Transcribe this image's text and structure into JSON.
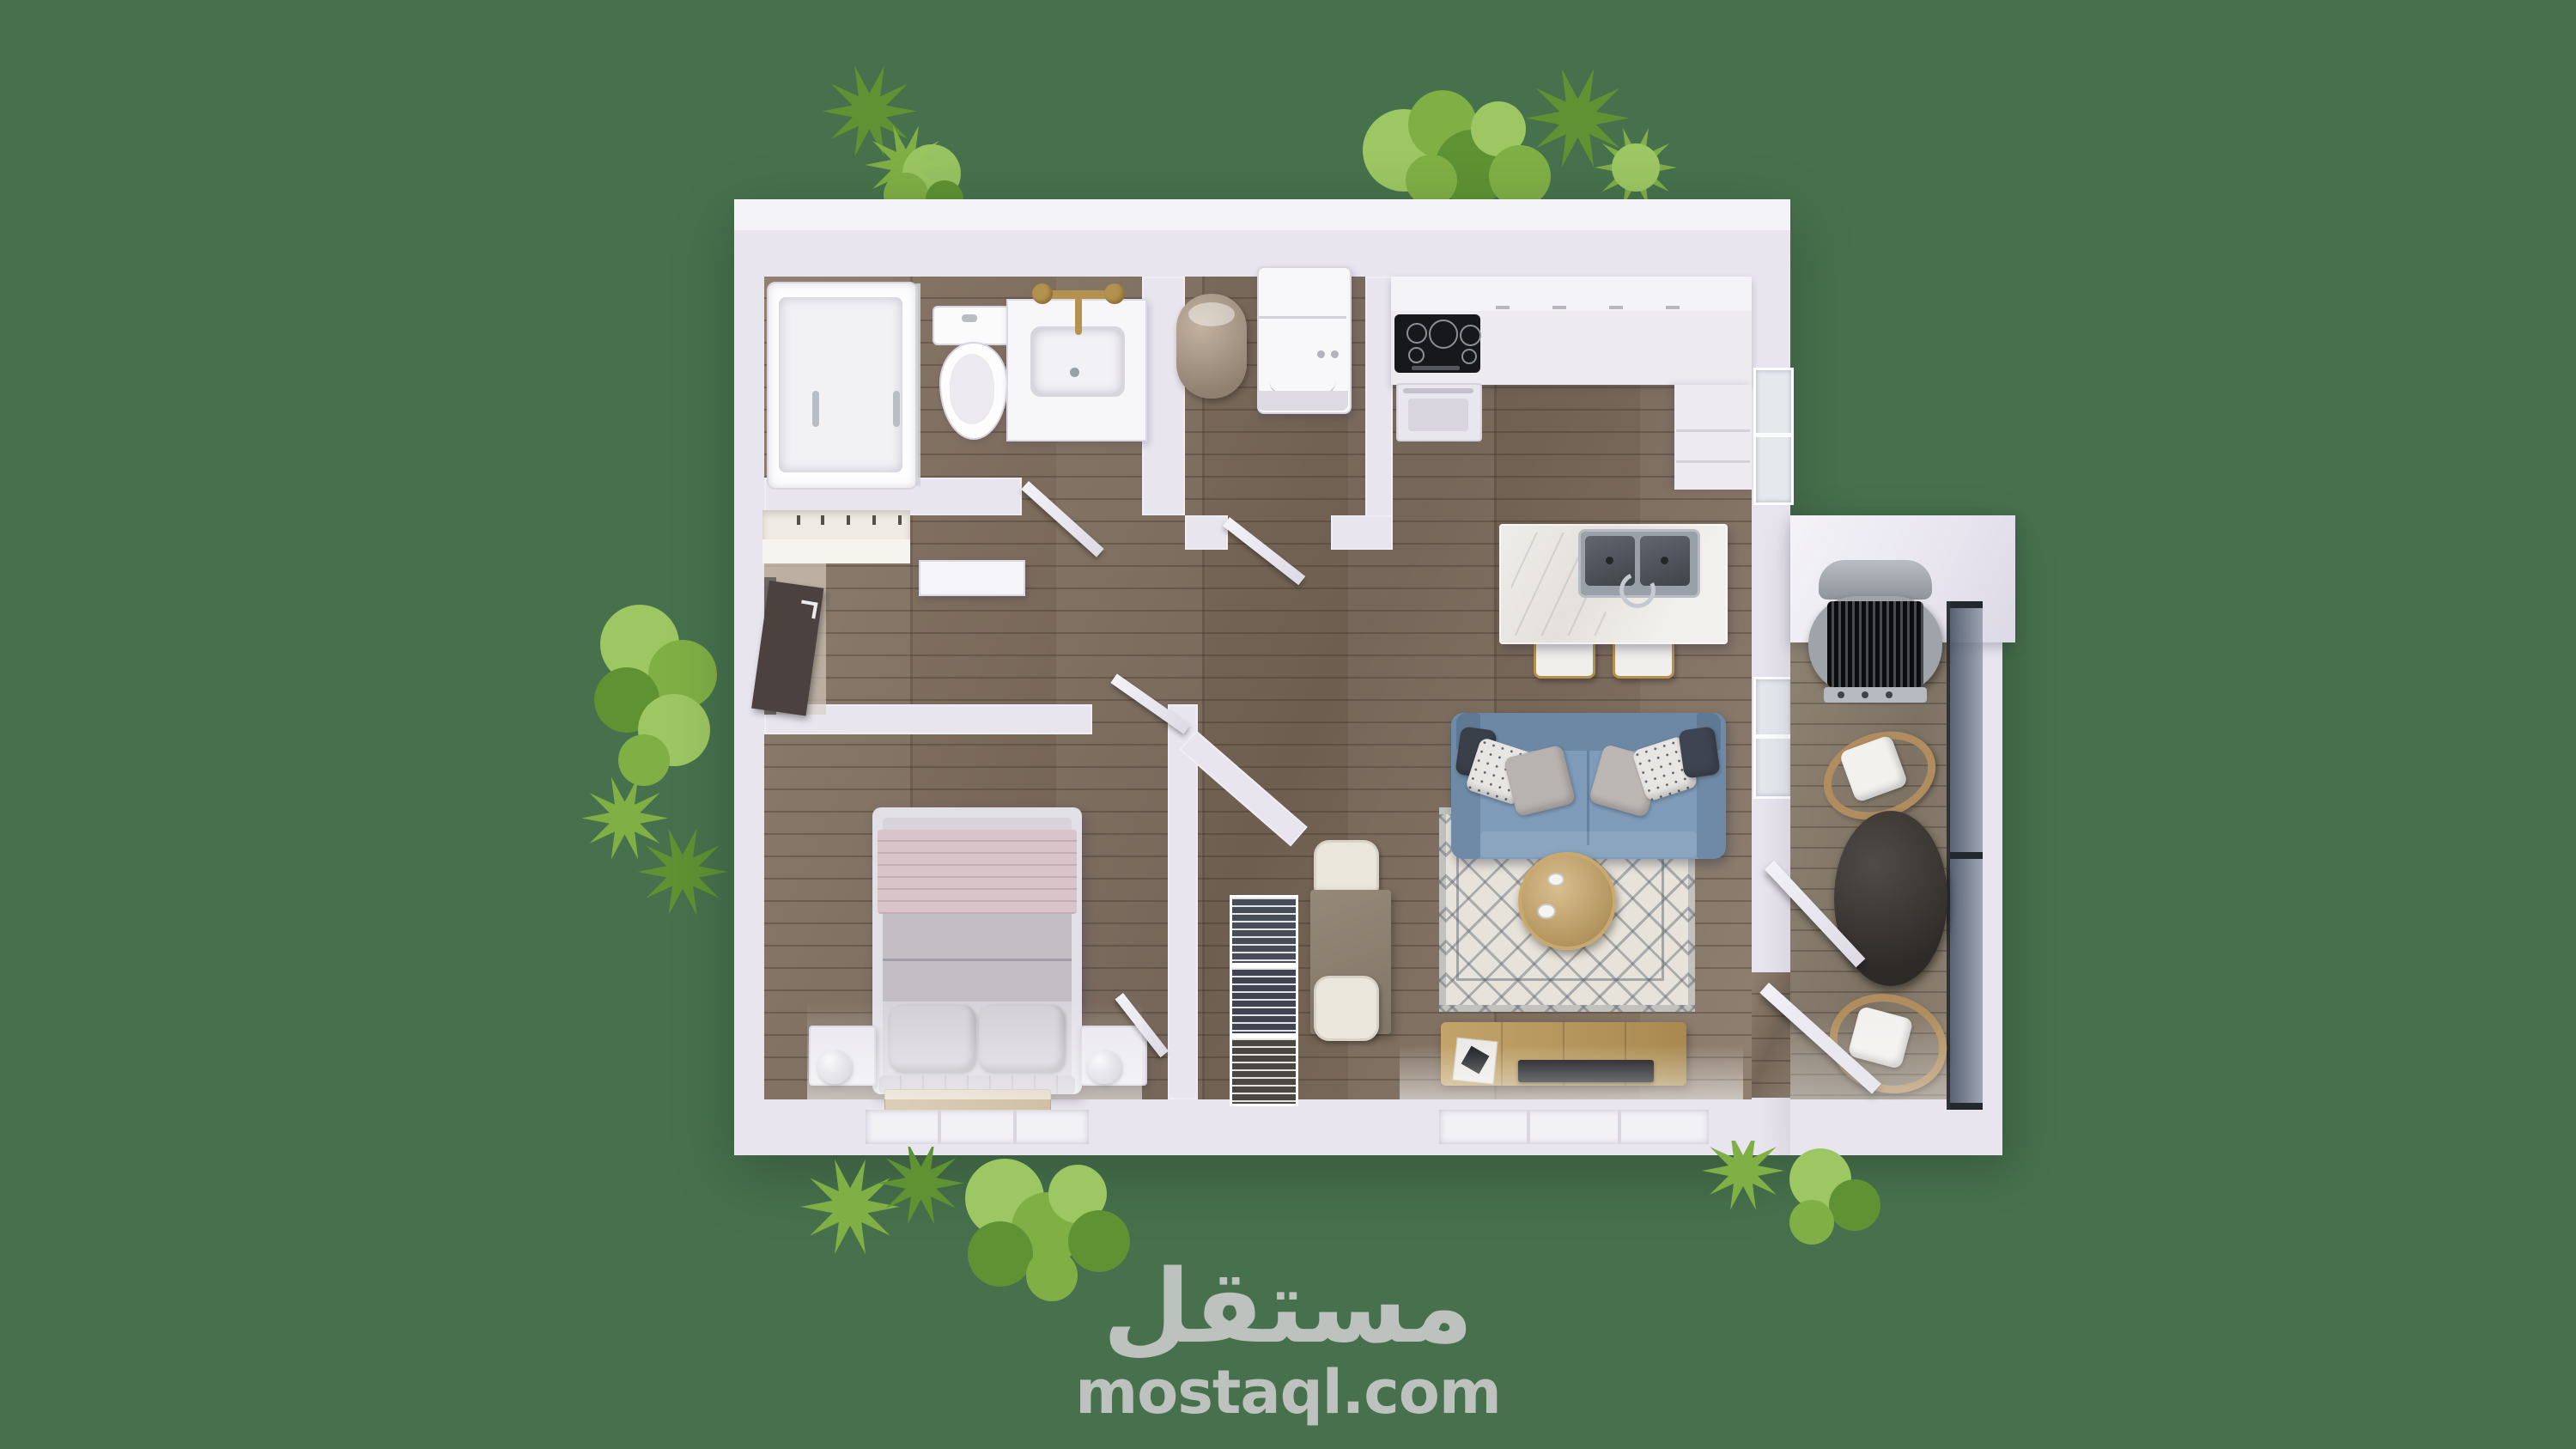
{
  "watermark": {
    "logo_text": "مستقل",
    "url_text": "mostaql.com"
  },
  "palette": {
    "bg": "#47714d",
    "wall": "#e8e5ef",
    "wall-bright": "#f4f3f8",
    "floor": "#8a7969",
    "floor-dark": "#6e5e50",
    "balcony-floor": "#8d8171",
    "sofa": "#7e9bb9",
    "rug": "#e8e3da",
    "rug-line": "#5f6774",
    "wood-tan": "#b7995f",
    "coffee-wood": "#c6aa77",
    "gold": "#b3914e",
    "pink": "#d9c5c9",
    "textile": "#bebac0",
    "steel": "#8f959d",
    "door-wood": "#4b4240",
    "glass": "#5e6c80",
    "tile": "#d7cec2",
    "tree1": "#7faf45",
    "tree2": "#5e9232",
    "tree3": "#9cc763",
    "watermark": "#c9c9c9"
  },
  "scene": {
    "type": "3d-floor-plan-top-view",
    "rooms": [
      "bathroom",
      "laundry-room",
      "kitchen",
      "living-room",
      "entry-hall",
      "bedroom",
      "closet",
      "dining-nook",
      "balcony"
    ],
    "furniture": [
      "bathtub-shower",
      "toilet",
      "vanity-sink",
      "gold-faucet",
      "water-heater",
      "washing-machine",
      "cooktop",
      "oven",
      "kitchen-counter",
      "kitchen-island",
      "double-sink",
      "bar-stool",
      "bar-stool",
      "blue-sofa",
      "throw-pillows",
      "area-rug",
      "round-coffee-table",
      "tv-console",
      "tv",
      "entry-door",
      "coat-hooks",
      "hall-cabinet",
      "double-bed",
      "pink-blanket",
      "nightstand",
      "nightstand",
      "sphere-lamp",
      "sphere-lamp",
      "accent-rug",
      "wire-basket-drawers",
      "dining-table",
      "dining-chair",
      "dining-chair",
      "bbq-grill",
      "outdoor-chair",
      "outdoor-chair",
      "outdoor-table",
      "glass-railing",
      "open-door-panel"
    ],
    "vegetation": [
      "tree-top-left",
      "tree-top-right",
      "tree-left",
      "tree-bottom-left",
      "tree-bottom-right"
    ]
  }
}
